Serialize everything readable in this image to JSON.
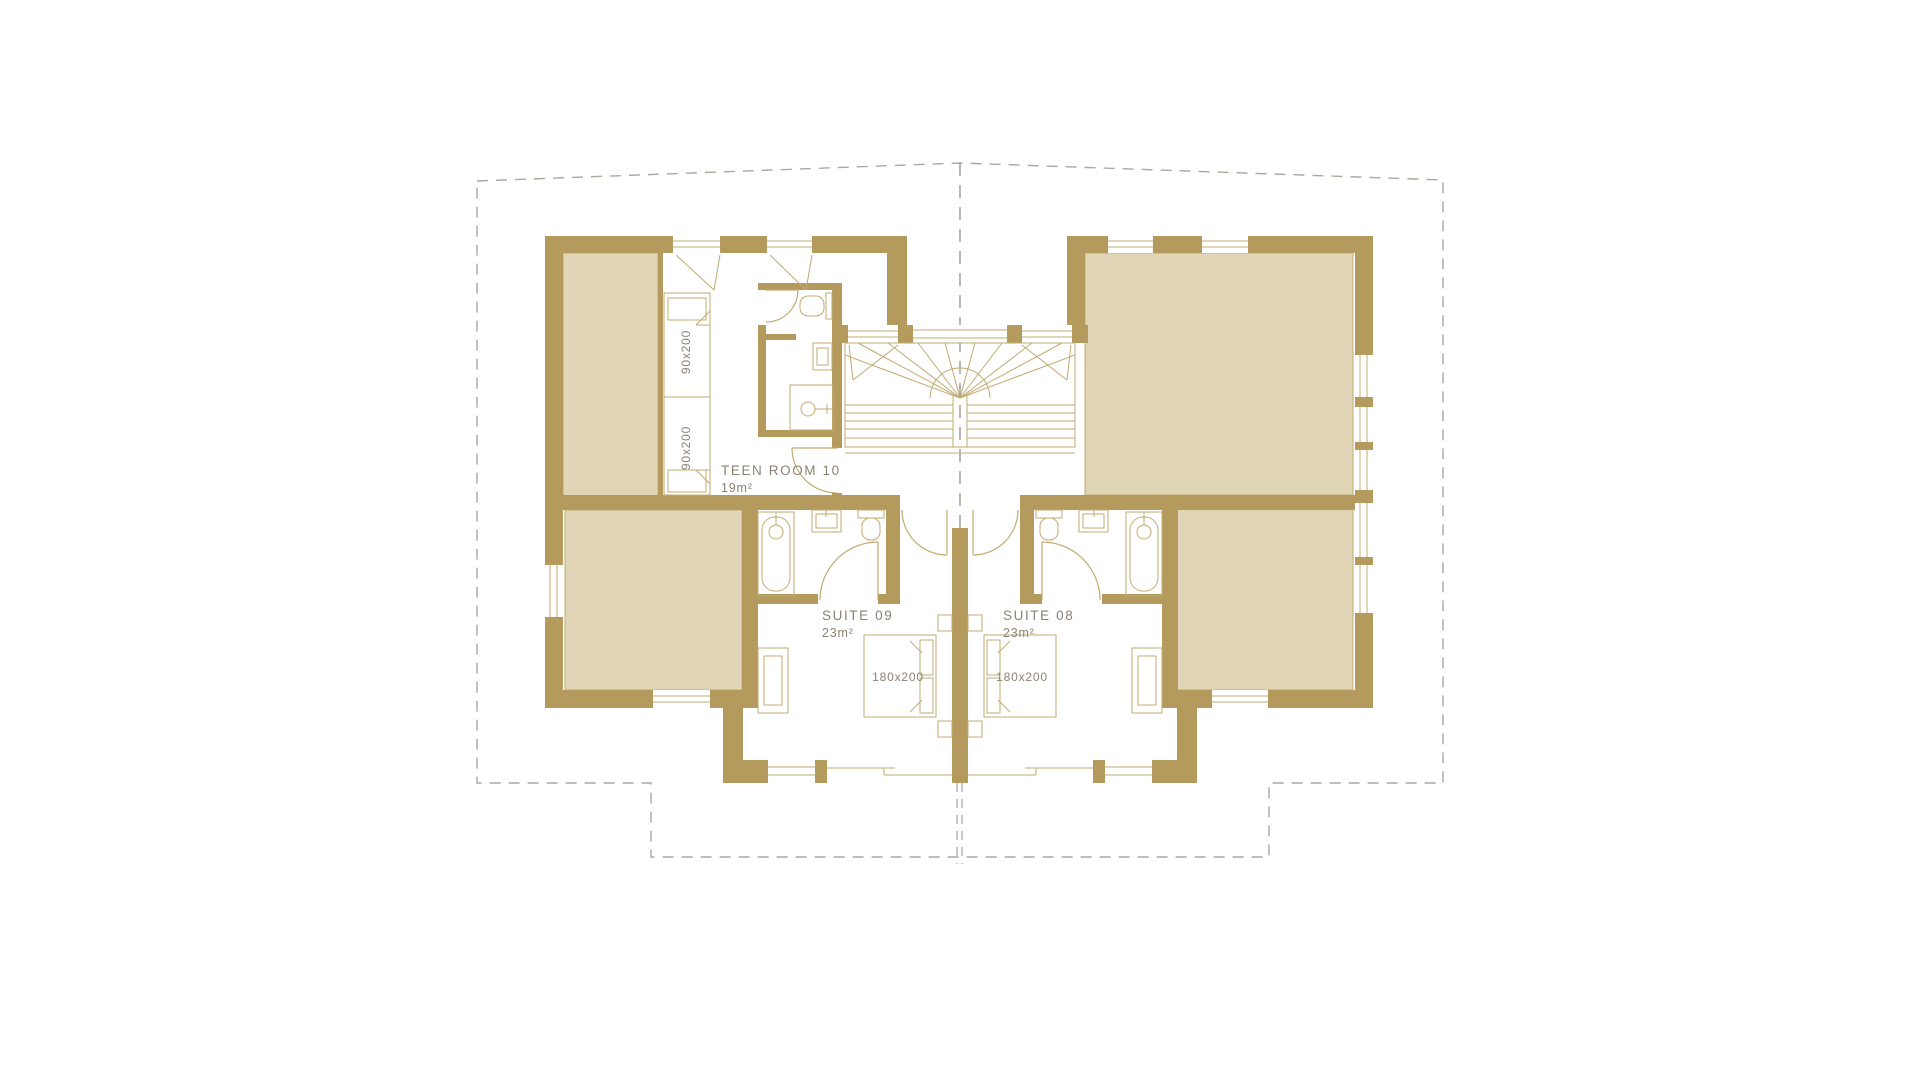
{
  "plan": {
    "rooms": {
      "teen_room": {
        "label": "TEEN ROOM 10",
        "area": "19m²"
      },
      "suite_09": {
        "label": "SUITE 09",
        "area": "23m²"
      },
      "suite_08": {
        "label": "SUITE 08",
        "area": "23m²"
      }
    },
    "bed_sizes": {
      "single": "90x200",
      "double": "180x200"
    },
    "colors": {
      "wall": "#b49a5c",
      "room-fill": "#e1d5b8",
      "line": "#c2ab72",
      "label": "#8c8272",
      "boundary": "#a9a99f",
      "axis": "#90908a"
    }
  }
}
